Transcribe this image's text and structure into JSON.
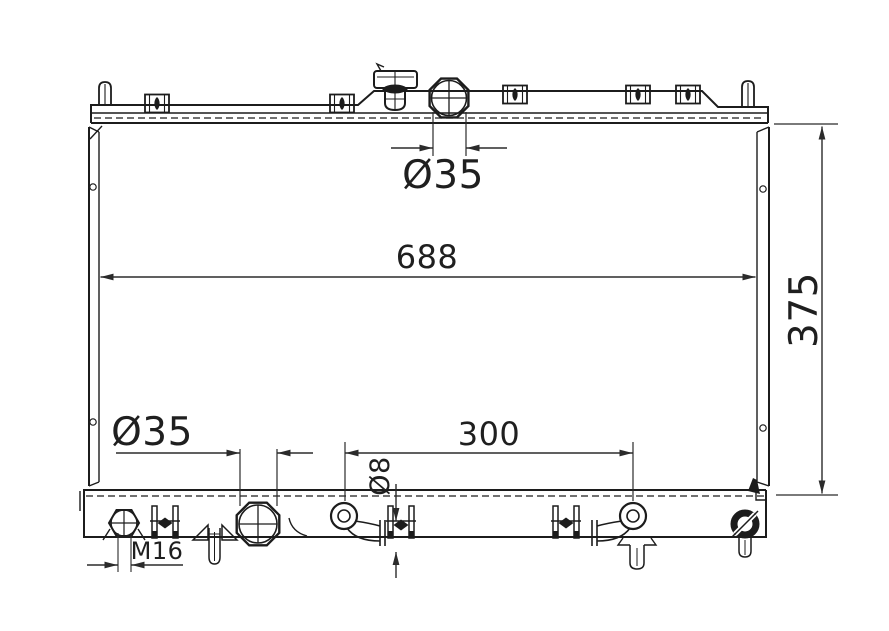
{
  "drawing_colors": {
    "line": "#1c1c1c",
    "dimension_line": "#2b2b2b",
    "background": "#ffffff"
  },
  "dimension_labels": {
    "top_inlet_diameter": "Ø35",
    "core_width": "688",
    "core_height": "375",
    "bottom_outlet_diameter": "Ø35",
    "bottom_fitting_spacing": "300",
    "drain_hole_diameter": "Ø8",
    "drain_plug_thread": "M16"
  }
}
